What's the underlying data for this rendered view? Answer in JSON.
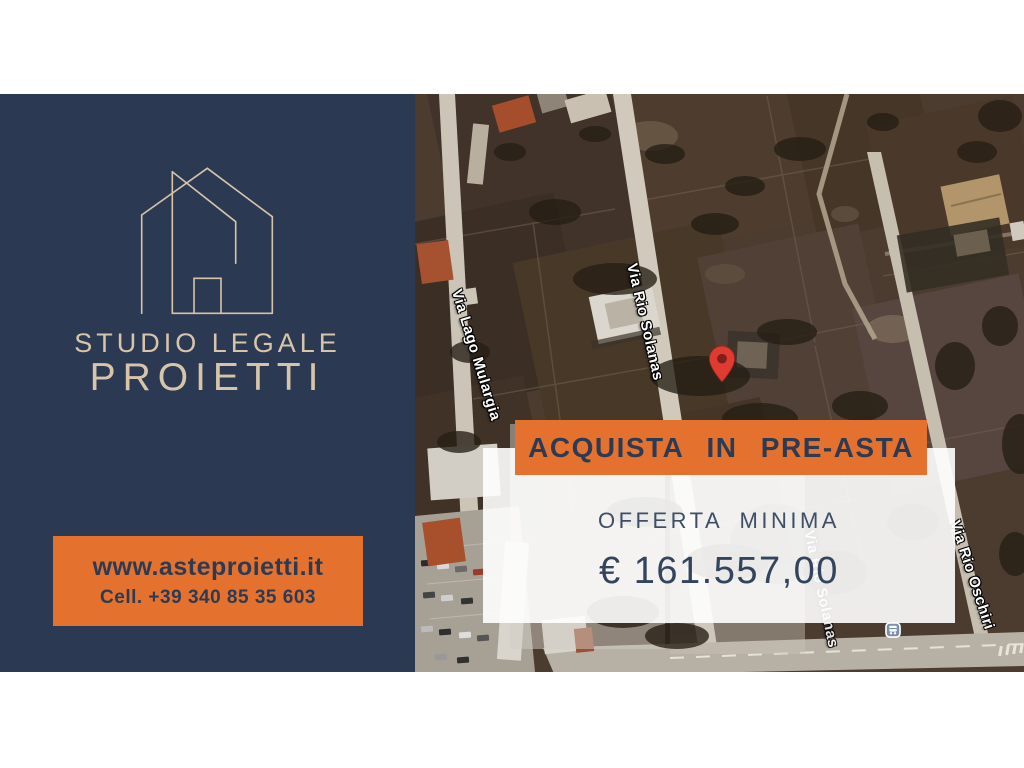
{
  "brand": {
    "logo_icon": "house-outline-icon",
    "studio_line": "STUDIO LEGALE",
    "name_line": "PROIETTI",
    "website": "www.asteproietti.it",
    "phone": "Cell. +39 340 85 35 603"
  },
  "offer": {
    "banner_label": "ACQUISTA IN PRE-ASTA",
    "min_offer_label": "OFFERTA MINIMA",
    "min_offer_amount": "€ 161.557,00"
  },
  "map": {
    "type": "satellite",
    "streets": [
      {
        "label": "Via Lago Mulargia"
      },
      {
        "label": "Via Rio Solanas"
      },
      {
        "label": "Via Rio Oschiri"
      }
    ],
    "marker_icon": "map-pin-icon",
    "bus_stop_icon": "bus-stop-icon"
  },
  "colors": {
    "navy": "#2b3a52",
    "tan": "#d8c5a9",
    "orange": "#e4712e",
    "text_navy": "#2c3b54",
    "pin_red": "#df3b30"
  }
}
